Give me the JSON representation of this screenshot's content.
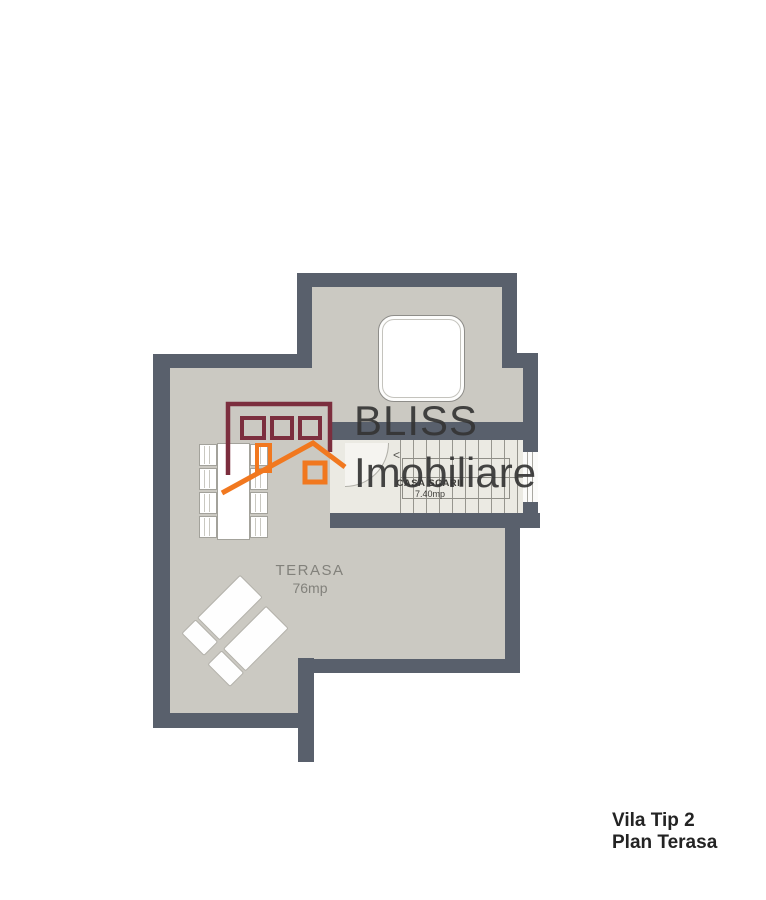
{
  "canvas": {
    "width": 766,
    "height": 900,
    "background": "#ffffff"
  },
  "watermark": {
    "brand_line1": "BLISS",
    "brand_line2": "Imobiliare",
    "text_color": "#343434",
    "logo_icon": "bliss-house-logo-icon",
    "logo_maroon": "#7c2e3e",
    "logo_orange": "#f1781f"
  },
  "rooms": {
    "terrace": {
      "label": "TERASA",
      "area": "76mp"
    },
    "staircase": {
      "label": "CASA SCARII",
      "area": "7.40mp",
      "direction_arrow": "<"
    }
  },
  "caption": {
    "line1": "Vila Tip 2",
    "line2": "Plan Terasa"
  },
  "colors": {
    "wall": "#59606c",
    "terrace_floor": "#cbc9c2",
    "staircase_floor": "#ebeae3",
    "furniture_outline": "#a3a29b",
    "room_label_gray": "#82817b",
    "room_label_dark": "#3f3e3a"
  }
}
